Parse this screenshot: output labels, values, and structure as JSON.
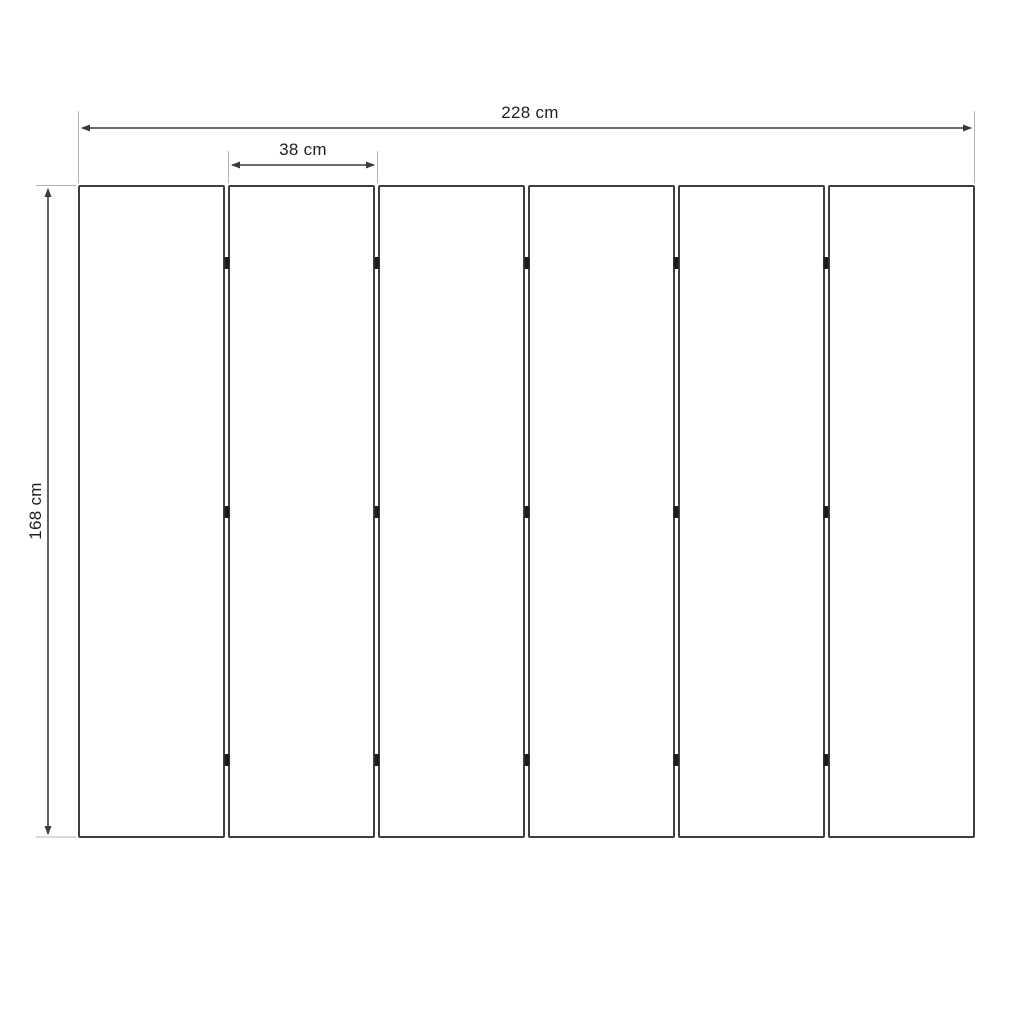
{
  "diagram": {
    "kind": "panel-dimension-drawing",
    "panel_count": 6,
    "junction_count": 5,
    "hinge_rows_percent": [
      12,
      50,
      88
    ],
    "dimensions": {
      "total_width_label": "228 cm",
      "panel_width_label": "38 cm",
      "height_label": "168 cm"
    },
    "colors": {
      "panel_border": "#3f3f3f",
      "hinge": "#1c1c1c",
      "dimension_line": "#3a3a3a",
      "extension_line": "#b3b3b3",
      "text": "#1f1f1f",
      "background": "#ffffff"
    }
  }
}
